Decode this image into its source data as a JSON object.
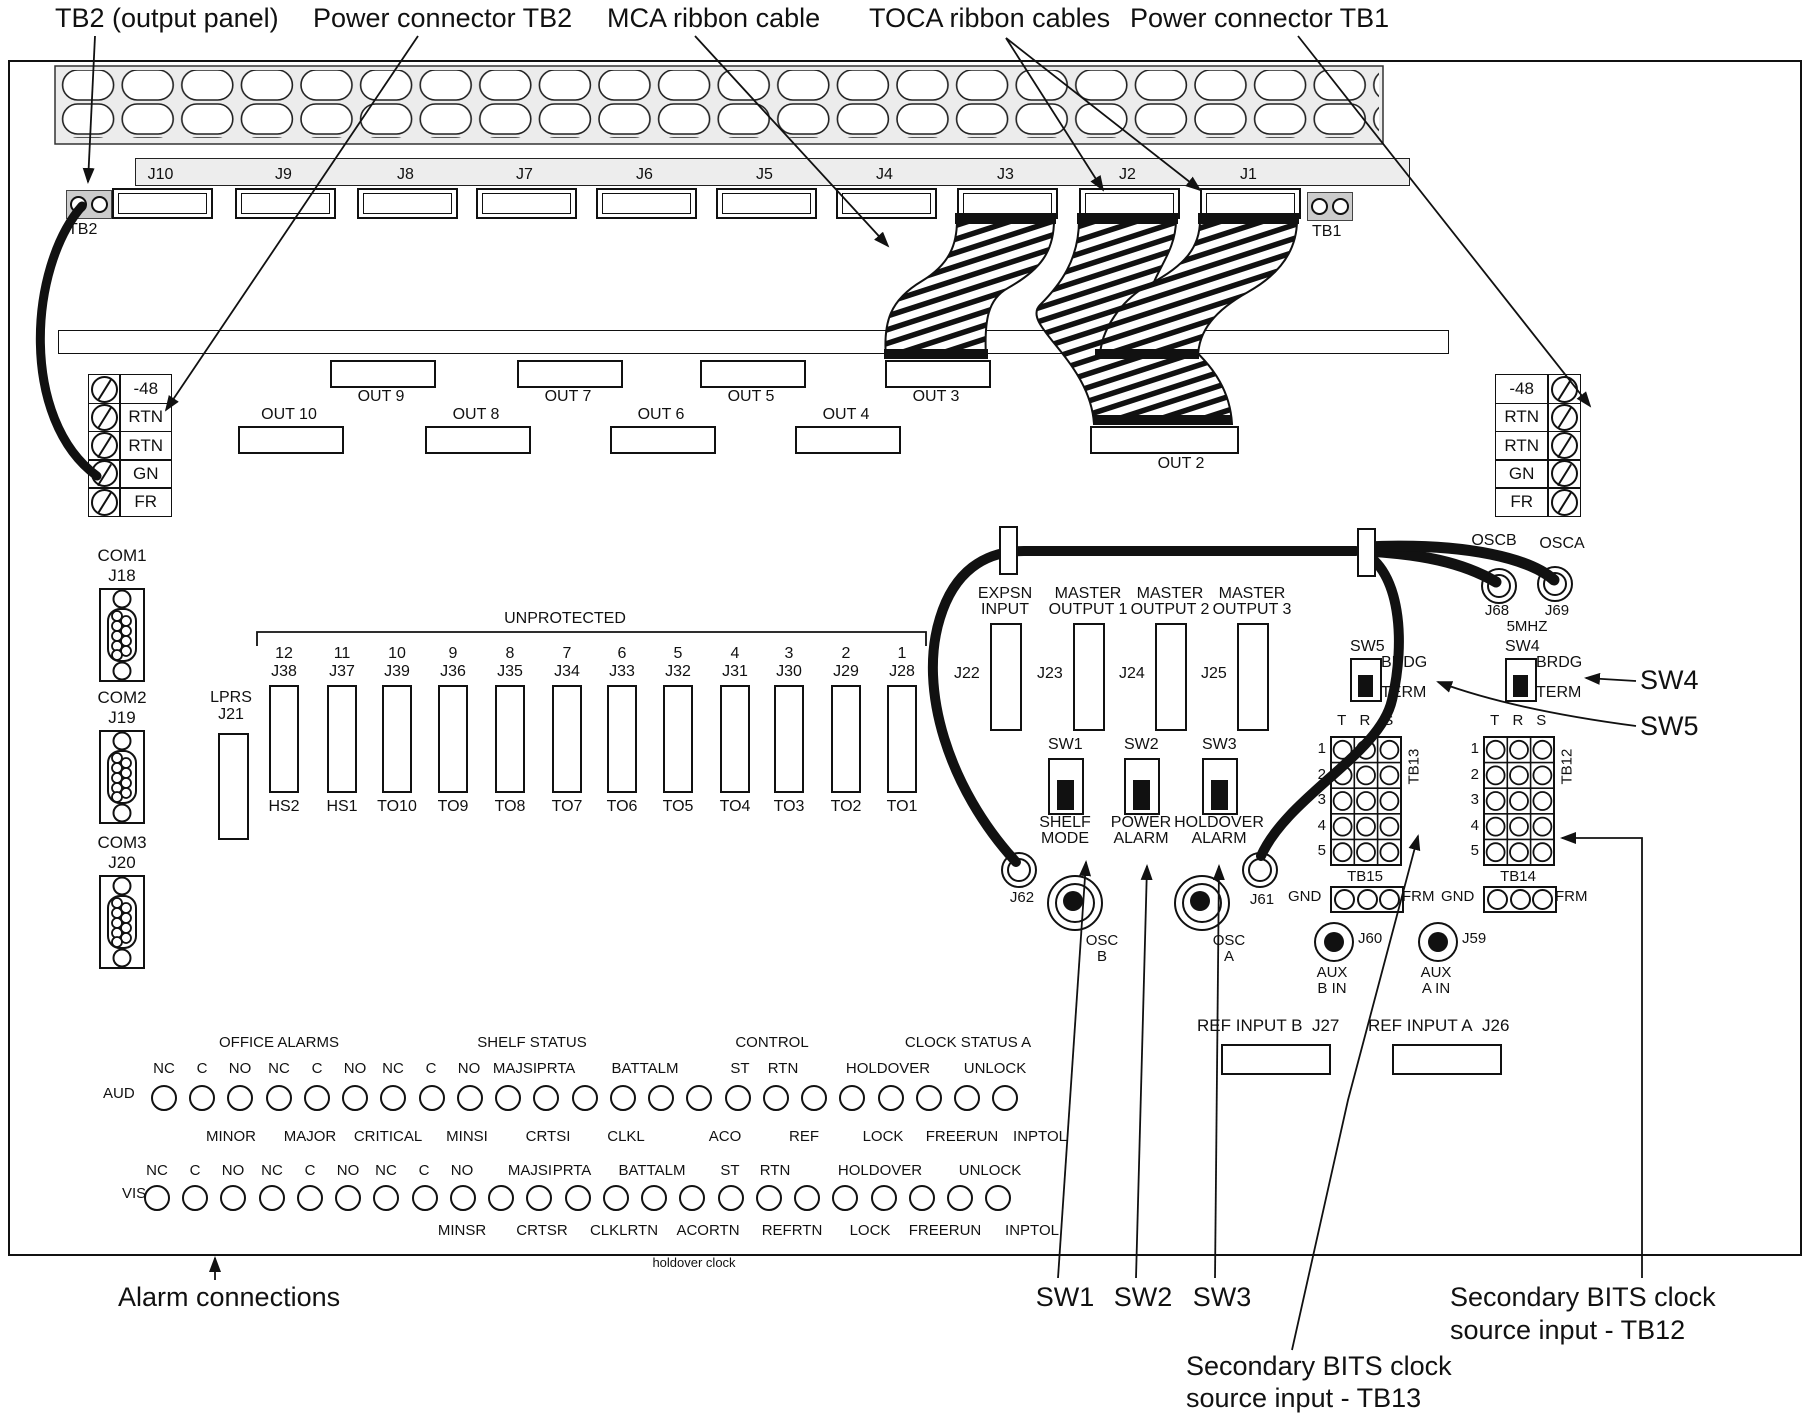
{
  "callouts": {
    "tb2_output_panel": "TB2 (output panel)",
    "power_connector_tb2": "Power connector TB2",
    "mca_ribbon_cable": "MCA ribbon cable",
    "toca_ribbon_cables": "TOCA ribbon cables",
    "power_connector_tb1": "Power connector TB1",
    "alarm_connections": "Alarm connections",
    "sw1": "SW1",
    "sw2": "SW2",
    "sw3": "SW3",
    "secondary_tb12_line1": "Secondary BITS clock",
    "secondary_tb12_line2": "source input - TB12",
    "secondary_tb13_line1": "Secondary BITS clock",
    "secondary_tb13_line2": "source input - TB13",
    "holdover_clock": "holdover clock"
  },
  "top_row": {
    "tb2": "TB2",
    "tb1": "TB1",
    "jacks": [
      {
        "label": "J10",
        "x": 112
      },
      {
        "label": "J9",
        "x": 235
      },
      {
        "label": "J8",
        "x": 357
      },
      {
        "label": "J7",
        "x": 476
      },
      {
        "label": "J6",
        "x": 596
      },
      {
        "label": "J5",
        "x": 716
      },
      {
        "label": "J4",
        "x": 836
      },
      {
        "label": "J3",
        "x": 957
      },
      {
        "label": "J2",
        "x": 1079
      },
      {
        "label": "J1",
        "x": 1200
      }
    ]
  },
  "out_upper": [
    {
      "label": "OUT 9",
      "x": 330
    },
    {
      "label": "OUT 7",
      "x": 517
    },
    {
      "label": "OUT 5",
      "x": 700
    },
    {
      "label": "OUT 3",
      "x": 885
    },
    {
      "label": "OUT 1",
      "x": 1096
    }
  ],
  "out_lower": [
    {
      "label": "OUT 10",
      "x": 238
    },
    {
      "label": "OUT 8",
      "x": 425
    },
    {
      "label": "OUT 6",
      "x": 610
    },
    {
      "label": "OUT 4",
      "x": 795
    }
  ],
  "out2": {
    "label": "OUT 2"
  },
  "power_block_left": {
    "rows": [
      {
        "label": "-48"
      },
      {
        "label": "RTN"
      },
      {
        "label": "RTN"
      },
      {
        "label": "GN"
      },
      {
        "label": "FR"
      }
    ]
  },
  "power_block_right": {
    "rows": [
      {
        "label": "-48"
      },
      {
        "label": "RTN"
      },
      {
        "label": "RTN"
      },
      {
        "label": "GN"
      },
      {
        "label": "FR"
      }
    ]
  },
  "com_ports": [
    {
      "name": "COM1",
      "jack": "J18",
      "y": 546
    },
    {
      "name": "COM2",
      "jack": "J19",
      "y": 688
    },
    {
      "name": "COM3",
      "jack": "J20",
      "y": 833
    }
  ],
  "lprs": {
    "name": "LPRS",
    "jack": "J21"
  },
  "unprotected": {
    "title": "UNPROTECTED",
    "slots": [
      {
        "num": "12",
        "jack": "J38",
        "tag": "HS2",
        "x": 255
      },
      {
        "num": "11",
        "jack": "J37",
        "tag": "HS1",
        "x": 313
      },
      {
        "num": "10",
        "jack": "J39",
        "tag": "TO10",
        "x": 368
      },
      {
        "num": "9",
        "jack": "J36",
        "tag": "TO9",
        "x": 424
      },
      {
        "num": "8",
        "jack": "J35",
        "tag": "TO8",
        "x": 481
      },
      {
        "num": "7",
        "jack": "J34",
        "tag": "TO7",
        "x": 538
      },
      {
        "num": "6",
        "jack": "J33",
        "tag": "TO6",
        "x": 593
      },
      {
        "num": "5",
        "jack": "J32",
        "tag": "TO5",
        "x": 649
      },
      {
        "num": "4",
        "jack": "J31",
        "tag": "TO4",
        "x": 706
      },
      {
        "num": "3",
        "jack": "J30",
        "tag": "TO3",
        "x": 760
      },
      {
        "num": "2",
        "jack": "J29",
        "tag": "TO2",
        "x": 817
      },
      {
        "num": "1",
        "jack": "J28",
        "tag": "TO1",
        "x": 873
      }
    ]
  },
  "master_ports": [
    {
      "top": "EXPSN",
      "bottom": "INPUT",
      "jack": "J22",
      "x": 990
    },
    {
      "top": "MASTER",
      "bottom": "OUTPUT 1",
      "jack": "J23",
      "x": 1073
    },
    {
      "top": "MASTER",
      "bottom": "OUTPUT 2",
      "jack": "J24",
      "x": 1155
    },
    {
      "top": "MASTER",
      "bottom": "OUTPUT 3",
      "jack": "J25",
      "x": 1237
    }
  ],
  "switches": [
    {
      "name": "SW1",
      "l1": "SHELF",
      "l2": "MODE",
      "x": 1048
    },
    {
      "name": "SW2",
      "l1": "POWER",
      "l2": "ALARM",
      "x": 1124
    },
    {
      "name": "SW3",
      "l1": "HOLDOVER",
      "l2": "ALARM",
      "x": 1202
    }
  ],
  "mode_switches": [
    {
      "name": "SW5",
      "brdg": "BRDG",
      "term": "TERM",
      "x": 1350
    },
    {
      "name": "SW4",
      "brdg": "BRDG",
      "term": "TERM",
      "x": 1505
    }
  ],
  "osc": {
    "j62": "J62",
    "j61": "J61",
    "oscb_l1": "OSC",
    "oscb_l2": "B",
    "osca_l1": "OSC",
    "osca_l2": "A",
    "oscb_top": "OSCB",
    "osca_top": "OSCA",
    "j68": "J68",
    "j69": "J69",
    "mhz": "5MHZ"
  },
  "grid_left": {
    "name": "TB13",
    "strip": "TB15",
    "gnd": "GND",
    "frm": "FRM",
    "cols": [
      "T",
      "R",
      "S"
    ],
    "rows": [
      "1",
      "2",
      "3",
      "4",
      "5"
    ]
  },
  "grid_right": {
    "name": "TB12",
    "strip": "TB14",
    "gnd": "GND",
    "frm": "FRM",
    "cols": [
      "T",
      "R",
      "S"
    ],
    "rows": [
      "1",
      "2",
      "3",
      "4",
      "5"
    ]
  },
  "aux_inputs": [
    {
      "jack": "J60",
      "l1": "AUX",
      "l2": "B IN",
      "x": 1312,
      "y": 922
    },
    {
      "jack": "J59",
      "l1": "AUX",
      "l2": "A IN",
      "x": 1416,
      "y": 922
    }
  ],
  "ref_inputs": [
    {
      "label": "REF INPUT B",
      "jack": "J27",
      "x": 1197
    },
    {
      "label": "REF INPUT A",
      "jack": "J26",
      "x": 1368
    }
  ],
  "alarm_field": {
    "aud": "AUD",
    "vis": "VIS",
    "headers": [
      {
        "t": "OFFICE ALARMS",
        "x": 279
      },
      {
        "t": "SHELF STATUS",
        "x": 532
      },
      {
        "t": "CONTROL",
        "x": 772
      },
      {
        "t": "CLOCK STATUS A",
        "x": 968
      }
    ],
    "aud_top": [
      {
        "t": "NC",
        "x": 164
      },
      {
        "t": "C",
        "x": 202
      },
      {
        "t": "NO",
        "x": 240
      },
      {
        "t": "NC",
        "x": 279
      },
      {
        "t": "C",
        "x": 317
      },
      {
        "t": "NO",
        "x": 355
      },
      {
        "t": "NC",
        "x": 393
      },
      {
        "t": "C",
        "x": 431
      },
      {
        "t": "NO",
        "x": 469
      },
      {
        "t": "MAJSI",
        "x": 515
      },
      {
        "t": "PRTA",
        "x": 556
      },
      {
        "t": "BATTALM",
        "x": 645
      },
      {
        "t": "ST",
        "x": 740
      },
      {
        "t": "RTN",
        "x": 783
      },
      {
        "t": "HOLDOVER",
        "x": 888
      },
      {
        "t": "UNLOCK",
        "x": 995
      }
    ],
    "aud_circles": [
      {
        "x": 151
      },
      {
        "x": 189
      },
      {
        "x": 227
      },
      {
        "x": 266
      },
      {
        "x": 304
      },
      {
        "x": 342
      },
      {
        "x": 380
      },
      {
        "x": 419
      },
      {
        "x": 457
      },
      {
        "x": 495
      },
      {
        "x": 533
      },
      {
        "x": 572
      },
      {
        "x": 610
      },
      {
        "x": 648
      },
      {
        "x": 686
      },
      {
        "x": 725
      },
      {
        "x": 763
      },
      {
        "x": 801
      },
      {
        "x": 839
      },
      {
        "x": 878
      },
      {
        "x": 916
      },
      {
        "x": 954
      },
      {
        "x": 992
      }
    ],
    "mid_labels": [
      {
        "t": "MINOR",
        "x": 231
      },
      {
        "t": "MAJOR",
        "x": 310
      },
      {
        "t": "CRITICAL",
        "x": 388
      },
      {
        "t": "MINSI",
        "x": 467
      },
      {
        "t": "CRTSI",
        "x": 548
      },
      {
        "t": "CLKL",
        "x": 626
      },
      {
        "t": "ACO",
        "x": 725
      },
      {
        "t": "REF",
        "x": 804
      },
      {
        "t": "LOCK",
        "x": 883
      },
      {
        "t": "FREERUN",
        "x": 962
      },
      {
        "t": "INPTOL",
        "x": 1040
      }
    ],
    "vis_top": [
      {
        "t": "NC",
        "x": 157
      },
      {
        "t": "C",
        "x": 195
      },
      {
        "t": "NO",
        "x": 233
      },
      {
        "t": "NC",
        "x": 272
      },
      {
        "t": "C",
        "x": 310
      },
      {
        "t": "NO",
        "x": 348
      },
      {
        "t": "NC",
        "x": 386
      },
      {
        "t": "C",
        "x": 424
      },
      {
        "t": "NO",
        "x": 462
      },
      {
        "t": "MAJSI",
        "x": 530
      },
      {
        "t": "PRTA",
        "x": 572
      },
      {
        "t": "BATTALM",
        "x": 652
      },
      {
        "t": "ST",
        "x": 730
      },
      {
        "t": "RTN",
        "x": 775
      },
      {
        "t": "HOLDOVER",
        "x": 880
      },
      {
        "t": "UNLOCK",
        "x": 990
      }
    ],
    "vis_circles": [
      {
        "x": 144
      },
      {
        "x": 182
      },
      {
        "x": 220
      },
      {
        "x": 259
      },
      {
        "x": 297
      },
      {
        "x": 335
      },
      {
        "x": 373
      },
      {
        "x": 412
      },
      {
        "x": 450
      },
      {
        "x": 488
      },
      {
        "x": 526
      },
      {
        "x": 565
      },
      {
        "x": 603
      },
      {
        "x": 641
      },
      {
        "x": 679
      },
      {
        "x": 718
      },
      {
        "x": 756
      },
      {
        "x": 794
      },
      {
        "x": 832
      },
      {
        "x": 871
      },
      {
        "x": 909
      },
      {
        "x": 947
      },
      {
        "x": 985
      }
    ],
    "vis_bottom": [
      {
        "t": "MINSR",
        "x": 462
      },
      {
        "t": "CRTSR",
        "x": 542
      },
      {
        "t": "CLKLRTN",
        "x": 624
      },
      {
        "t": "ACORTN",
        "x": 708
      },
      {
        "t": "REFRTN",
        "x": 792
      },
      {
        "t": "LOCK",
        "x": 870
      },
      {
        "t": "FREERUN",
        "x": 945
      },
      {
        "t": "INPTOL",
        "x": 1032
      }
    ]
  }
}
